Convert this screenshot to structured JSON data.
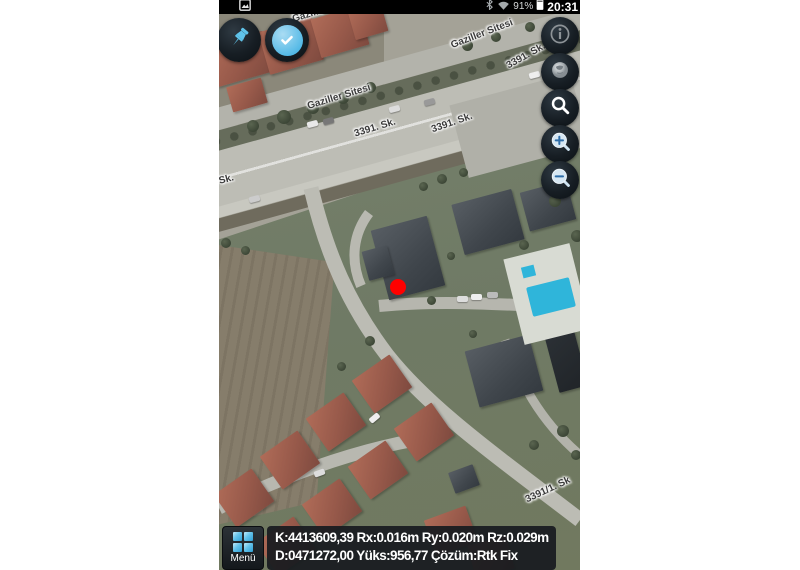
{
  "status_bar": {
    "time": "20:31",
    "battery": "91%",
    "icons": [
      "screenshot-icon",
      "bluetooth-icon",
      "wifi-icon",
      "battery-icon"
    ]
  },
  "toolbar": {
    "pin_button_icon": "pushpin-icon",
    "confirm_button_icon": "check-icon"
  },
  "map_controls": {
    "buttons": [
      {
        "id": "info-button",
        "icon": "info-icon"
      },
      {
        "id": "layers-globe-button",
        "icon": "globe-icon"
      },
      {
        "id": "search-button",
        "icon": "search-icon"
      },
      {
        "id": "zoom-in-button",
        "icon": "zoom-in-icon"
      },
      {
        "id": "zoom-out-button",
        "icon": "zoom-out-icon"
      }
    ]
  },
  "map_labels": [
    {
      "text": "Gaziller Sitesi",
      "x": 105,
      "y": 10,
      "rotate": -17
    },
    {
      "text": "Gaziller Sitesi",
      "x": 120,
      "y": 97,
      "rotate": -17
    },
    {
      "text": "3391. Sk.",
      "x": 156,
      "y": 128,
      "rotate": -17
    },
    {
      "text": "3391. Sk.",
      "x": 233,
      "y": 123,
      "rotate": -19
    },
    {
      "text": "Gaziller Sitesi",
      "x": 263,
      "y": 34,
      "rotate": -21
    },
    {
      "text": "3391. Sk.",
      "x": 307,
      "y": 56,
      "rotate": -29
    },
    {
      "text": "1. Sk.",
      "x": 2,
      "y": 181,
      "rotate": -15
    },
    {
      "text": "3391/1. Sk",
      "x": 329,
      "y": 490,
      "rotate": -25
    }
  ],
  "marker": {
    "name": "gps-position-marker",
    "color": "#ff0000"
  },
  "bottom_bar": {
    "menu_label": "Menü",
    "menu_icon": "grid-icon",
    "line1": "K:4413609,39 Rx:0.016m Ry:0.020m Rz:0.029m",
    "line2": "D:0471272,00 Yüks:956,77 Çözüm:Rtk Fix"
  },
  "colors": {
    "accent_blue": "#4fbbe8",
    "marker_red": "#ff0000",
    "pool_blue": "#2fb5da"
  }
}
